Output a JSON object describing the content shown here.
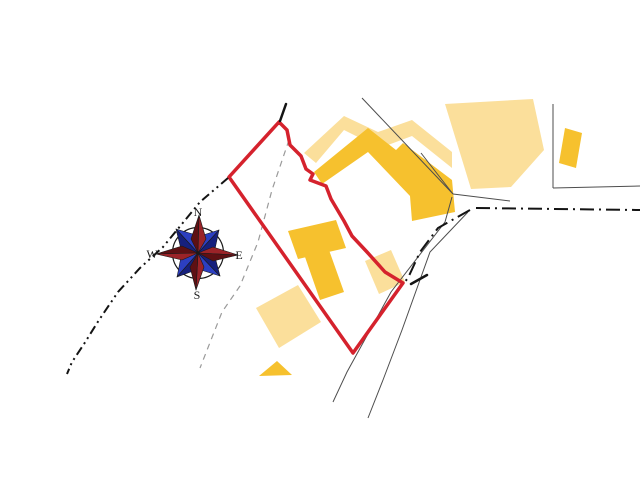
{
  "canvas": {
    "width": 640,
    "height": 480,
    "background": "#ffffff"
  },
  "map": {
    "colors": {
      "building_light": "#FBDF9B",
      "building_dark": "#F6C12E",
      "parcel_red": "#D5222D",
      "thin_line": "#4d4d4d",
      "dashed_gray": "#9a9a9a",
      "road_black": "#141414"
    },
    "buildings_light": [
      {
        "name": "building-light-northeast",
        "points": [
          [
            445,
            104
          ],
          [
            533,
            99
          ],
          [
            544,
            150
          ],
          [
            511,
            187
          ],
          [
            471,
            189
          ],
          [
            464,
            166
          ]
        ]
      },
      {
        "name": "building-light-roof-back",
        "points": [
          [
            304,
            153
          ],
          [
            344,
            116
          ],
          [
            378,
            132
          ],
          [
            412,
            120
          ],
          [
            452,
            152
          ],
          [
            452,
            168
          ],
          [
            412,
            136
          ],
          [
            380,
            148
          ],
          [
            344,
            130
          ],
          [
            316,
            163
          ]
        ]
      },
      {
        "name": "building-light-center",
        "points": [
          [
            365,
            261
          ],
          [
            391,
            250
          ],
          [
            405,
            282
          ],
          [
            379,
            294
          ]
        ]
      },
      {
        "name": "building-light-southwest",
        "points": [
          [
            256,
            308
          ],
          [
            298,
            285
          ],
          [
            321,
            322
          ],
          [
            279,
            348
          ]
        ]
      }
    ],
    "buildings_dark": [
      {
        "name": "building-dark-main",
        "points": [
          [
            314,
            172
          ],
          [
            368,
            128
          ],
          [
            396,
            150
          ],
          [
            403,
            143
          ],
          [
            452,
            180
          ],
          [
            455,
            212
          ],
          [
            412,
            221
          ],
          [
            410,
            196
          ],
          [
            368,
            152
          ],
          [
            322,
            184
          ]
        ]
      },
      {
        "name": "building-dark-annex-upper",
        "points": [
          [
            288,
            231
          ],
          [
            336,
            220
          ],
          [
            346,
            248
          ],
          [
            298,
            259
          ]
        ]
      },
      {
        "name": "building-dark-annex-lower",
        "points": [
          [
            305,
            257
          ],
          [
            329,
            250
          ],
          [
            344,
            292
          ],
          [
            320,
            300
          ]
        ]
      },
      {
        "name": "building-dark-east",
        "points": [
          [
            565,
            128
          ],
          [
            582,
            133
          ],
          [
            576,
            168
          ],
          [
            559,
            163
          ]
        ]
      },
      {
        "name": "building-dark-small-triangle",
        "points": [
          [
            259,
            376
          ],
          [
            277,
            361
          ],
          [
            292,
            375
          ]
        ]
      }
    ],
    "thin_lines": [
      {
        "name": "parcel-line-northwest",
        "points": [
          [
            362,
            98
          ],
          [
            453,
            194
          ]
        ]
      },
      {
        "name": "parcel-line-west-spur",
        "points": [
          [
            421,
            153
          ],
          [
            453,
            194
          ]
        ]
      },
      {
        "name": "road-edge-east",
        "points": [
          [
            453,
            194
          ],
          [
            510,
            201
          ]
        ]
      },
      {
        "name": "parcel-corner-vertical",
        "points": [
          [
            553,
            104
          ],
          [
            553,
            188
          ]
        ]
      },
      {
        "name": "parcel-corner-horizontal",
        "points": [
          [
            553,
            188
          ],
          [
            640,
            186
          ]
        ]
      },
      {
        "name": "road-edge-left",
        "points": [
          [
            452,
            197
          ],
          [
            445,
            222
          ],
          [
            391,
            292
          ],
          [
            347,
            372
          ],
          [
            333,
            402
          ]
        ]
      },
      {
        "name": "road-edge-right",
        "points": [
          [
            468,
            212
          ],
          [
            430,
            252
          ],
          [
            402,
            330
          ],
          [
            383,
            380
          ],
          [
            368,
            418
          ]
        ]
      }
    ],
    "dashed_lines": [
      {
        "name": "boundary-dashed",
        "points": [
          [
            289,
            140
          ],
          [
            272,
            190
          ],
          [
            258,
            242
          ],
          [
            240,
            286
          ],
          [
            222,
            312
          ],
          [
            200,
            368
          ]
        ]
      }
    ],
    "dashdot_lines": [
      {
        "name": "road-centerline-east",
        "points": [
          [
            476,
            208
          ],
          [
            640,
            210
          ]
        ]
      },
      {
        "name": "road-centerline-bend",
        "points": [
          [
            470,
            210
          ],
          [
            438,
            228
          ],
          [
            420,
            252
          ],
          [
            408,
            278
          ],
          [
            403,
            284
          ]
        ]
      }
    ],
    "dashdotdot_lines": [
      {
        "name": "path-centerline-west",
        "points": [
          [
            228,
            178
          ],
          [
            200,
            202
          ],
          [
            163,
            247
          ],
          [
            140,
            268
          ],
          [
            118,
            292
          ],
          [
            99,
            320
          ],
          [
            84,
            344
          ],
          [
            72,
            362
          ],
          [
            67,
            374
          ]
        ]
      }
    ],
    "ticks": [
      {
        "name": "apex-tick",
        "points": [
          [
            280,
            121
          ],
          [
            286,
            104
          ]
        ]
      },
      {
        "name": "corner-tick",
        "points": [
          [
            411,
            284
          ],
          [
            427,
            275
          ]
        ]
      }
    ],
    "parcel_boundary": {
      "name": "selected-parcel-boundary",
      "stroke_width": 3.5,
      "points": [
        [
          279,
          122
        ],
        [
          287,
          130
        ],
        [
          290,
          145
        ],
        [
          301,
          156
        ],
        [
          306,
          169
        ],
        [
          313,
          174
        ],
        [
          310,
          180
        ],
        [
          326,
          186
        ],
        [
          331,
          199
        ],
        [
          344,
          221
        ],
        [
          352,
          236
        ],
        [
          367,
          252
        ],
        [
          385,
          272
        ],
        [
          403,
          283
        ],
        [
          353,
          353
        ],
        [
          229,
          177
        ]
      ]
    }
  },
  "compass": {
    "name": "compass-rose",
    "center": [
      198,
      253
    ],
    "radius": 25.5,
    "ring_color": "#1a1a1a",
    "outline_color": "#1a1a1a",
    "labels": [
      {
        "id": "n",
        "text": "N",
        "x": 198,
        "y": 216
      },
      {
        "id": "s",
        "text": "S",
        "x": 197,
        "y": 299
      },
      {
        "id": "w",
        "text": "W",
        "x": 152,
        "y": 258
      },
      {
        "id": "e",
        "text": "E",
        "x": 239,
        "y": 259
      }
    ],
    "needles": [
      {
        "id": "ne",
        "halves": [
          {
            "points": [
              [
                219,
                230
              ],
              [
                215,
                249
              ],
              [
                198,
                253
              ]
            ],
            "fill": "#16207d"
          },
          {
            "points": [
              [
                219,
                230
              ],
              [
                200,
                236
              ],
              [
                198,
                253
              ]
            ],
            "fill": "#2c3fc0"
          }
        ]
      },
      {
        "id": "nw",
        "halves": [
          {
            "points": [
              [
                176,
                229
              ],
              [
                196,
                235
              ],
              [
                198,
                253
              ]
            ],
            "fill": "#2c3fc0"
          },
          {
            "points": [
              [
                176,
                229
              ],
              [
                181,
                249
              ],
              [
                198,
                253
              ]
            ],
            "fill": "#16207d"
          }
        ]
      },
      {
        "id": "sw",
        "halves": [
          {
            "points": [
              [
                177,
                277
              ],
              [
                181,
                257
              ],
              [
                198,
                253
              ]
            ],
            "fill": "#2c3fc0"
          },
          {
            "points": [
              [
                177,
                277
              ],
              [
                196,
                270
              ],
              [
                198,
                253
              ]
            ],
            "fill": "#16207d"
          }
        ]
      },
      {
        "id": "se",
        "halves": [
          {
            "points": [
              [
                220,
                276
              ],
              [
                201,
                270
              ],
              [
                198,
                253
              ]
            ],
            "fill": "#2c3fc0"
          },
          {
            "points": [
              [
                220,
                276
              ],
              [
                215,
                257
              ],
              [
                198,
                253
              ]
            ],
            "fill": "#16207d"
          }
        ]
      },
      {
        "id": "n",
        "halves": [
          {
            "points": [
              [
                199,
                215
              ],
              [
                191,
                239
              ],
              [
                198,
                253
              ]
            ],
            "fill": "#5e1013"
          },
          {
            "points": [
              [
                199,
                215
              ],
              [
                206,
                239
              ],
              [
                198,
                253
              ]
            ],
            "fill": "#9b2328"
          }
        ]
      },
      {
        "id": "e",
        "halves": [
          {
            "points": [
              [
                238,
                255
              ],
              [
                213,
                247
              ],
              [
                198,
                253
              ]
            ],
            "fill": "#9b2328"
          },
          {
            "points": [
              [
                238,
                255
              ],
              [
                213,
                261
              ],
              [
                198,
                253
              ]
            ],
            "fill": "#5e1013"
          }
        ]
      },
      {
        "id": "s",
        "halves": [
          {
            "points": [
              [
                196,
                290
              ],
              [
                204,
                267
              ],
              [
                198,
                253
              ]
            ],
            "fill": "#9b2328"
          },
          {
            "points": [
              [
                196,
                290
              ],
              [
                190,
                267
              ],
              [
                198,
                253
              ]
            ],
            "fill": "#5e1013"
          }
        ]
      },
      {
        "id": "w",
        "halves": [
          {
            "points": [
              [
                156,
                254
              ],
              [
                182,
                246
              ],
              [
                198,
                253
              ]
            ],
            "fill": "#5e1013"
          },
          {
            "points": [
              [
                156,
                254
              ],
              [
                182,
                260
              ],
              [
                198,
                253
              ]
            ],
            "fill": "#9b2328"
          }
        ]
      }
    ]
  }
}
